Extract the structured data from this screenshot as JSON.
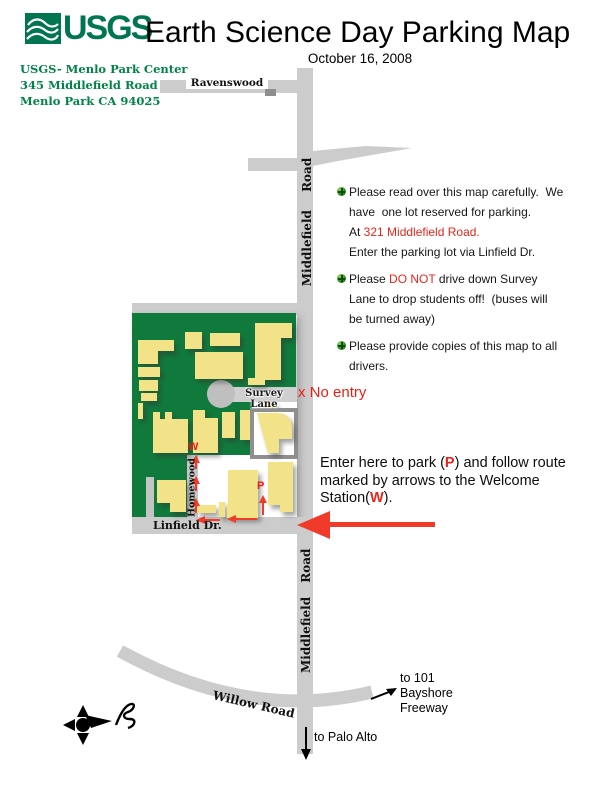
{
  "header": {
    "logo_text": "USGS",
    "title": "Earth Science Day Parking Map",
    "date": "October 16, 2008"
  },
  "address": {
    "line1": "USGS- Menlo Park Center",
    "line2": "345 Middlefield Road",
    "line3": "Menlo Park CA 94025"
  },
  "map_labels": {
    "ravenswood": "Ravenswood",
    "middlefield_top": "Middlefield Road",
    "middlefield_bottom": "Middlefield Road",
    "survey_lane": "Survey Lane",
    "no_entry": "x No entry",
    "homewood": "Homewood",
    "welcome_station": "W",
    "parking": "P",
    "linfield": "Linfield Dr.",
    "willow": "Willow Road",
    "to_101_line1": "to 101",
    "to_101_line2": "Bayshore",
    "to_101_line3": "Freeway",
    "to_palo_alto": "to Palo Alto"
  },
  "notes": {
    "n1": {
      "l1": "Please read over this map carefully.  We",
      "l2": "have  one lot reserved for parking.",
      "l3a": "At ",
      "l3b": "321 Middlefield Road.",
      "l4": "Enter the parking lot via Linfield Dr."
    },
    "n2": {
      "l1a": "Please ",
      "l1b": "DO NOT",
      "l1c": " drive down Survey",
      "l2": "Lane to drop students off!  (buses will",
      "l3": "be turned away)"
    },
    "n3": {
      "l1": "Please provide copies of this map to all",
      "l2": "drivers."
    }
  },
  "enter_note": {
    "l1a": "Enter here to park (",
    "l1b": "P",
    "l1c": ") and follow route",
    "l2": "marked by arrows to the Welcome",
    "l3a": "Station(",
    "l3b": "W",
    "l3c": ")."
  },
  "colors": {
    "usgs_green": "#007550",
    "campus_green": "#107a3c",
    "building_yellow": "#f2e388",
    "road_gray": "#cccccc",
    "alert_red": "#e8251c",
    "arrow_red": "#f03a2a"
  }
}
